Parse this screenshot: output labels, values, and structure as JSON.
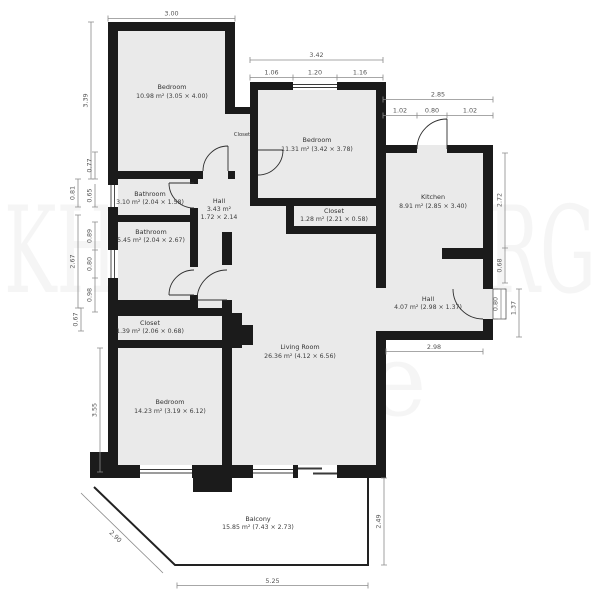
{
  "watermark": {
    "line1": "KHARTOUBERG",
    "line2": "Estate"
  },
  "rooms": {
    "bedroom1": {
      "name": "Bedroom",
      "area": "10.98 m² (3.05 × 4.00)"
    },
    "closet_top": {
      "name": "Closet"
    },
    "bedroom2": {
      "name": "Bedroom",
      "area": "11.31 m² (3.42 × 3.78)"
    },
    "kitchen": {
      "name": "Kitchen",
      "area": "8.91 m² (2.85 × 3.40)"
    },
    "bathroom1": {
      "name": "Bathroom",
      "area": "3.10 m² (2.04 × 1.58)"
    },
    "hall_center": {
      "name": "Hall",
      "area": "3.43 m²",
      "dims": "1.72 × 2.14"
    },
    "closet_center": {
      "name": "Closet",
      "area": "1.28 m² (2.21 × 0.58)"
    },
    "bathroom2": {
      "name": "Bathroom",
      "area": "5.45 m² (2.04 × 2.67)"
    },
    "closet_lower": {
      "name": "Closet",
      "area": "1.39 m² (2.06 × 0.68)"
    },
    "living_room": {
      "name": "Living Room",
      "area": "26.36 m² (4.12 × 6.56)"
    },
    "hall_entry": {
      "name": "Hall",
      "area": "4.07 m² (2.98 × 1.37)"
    },
    "bedroom3": {
      "name": "Bedroom",
      "area": "14.23 m² (3.19 × 6.12)"
    },
    "balcony": {
      "name": "Balcony",
      "area": "15.85 m² (7.43 × 2.73)"
    }
  },
  "dims": {
    "b1_top": "3.00",
    "b1_left": "3.39",
    "b2_total": "3.42",
    "b2_seg1": "1.06",
    "b2_seg2": "1.20",
    "b2_seg3": "1.16",
    "kitchen_total": "2.85",
    "kitchen_seg1": "1.02",
    "kitchen_seg2": "0.80",
    "kitchen_seg3": "1.02",
    "kitchen_right": "2.72",
    "right_step": "0.68",
    "entry_door": "0.80",
    "entry_depth": "1.37",
    "hall_width": "2.98",
    "left_1": "0.77",
    "left_2": "0.81",
    "left_3": "0.65",
    "left_4": "0.89",
    "left_5": "2.67",
    "left_6": "0.80",
    "left_7": "0.98",
    "left_8": "0.67",
    "left_9": "3.55",
    "balcony_slant": "2.90",
    "balcony_width": "5.25",
    "balcony_depth": "2.49"
  },
  "colors": {
    "wall": "#1b1b1b",
    "room_fill": "#eaeaea",
    "dim_line": "#8a8a8a",
    "balcony_line": "#222222"
  }
}
